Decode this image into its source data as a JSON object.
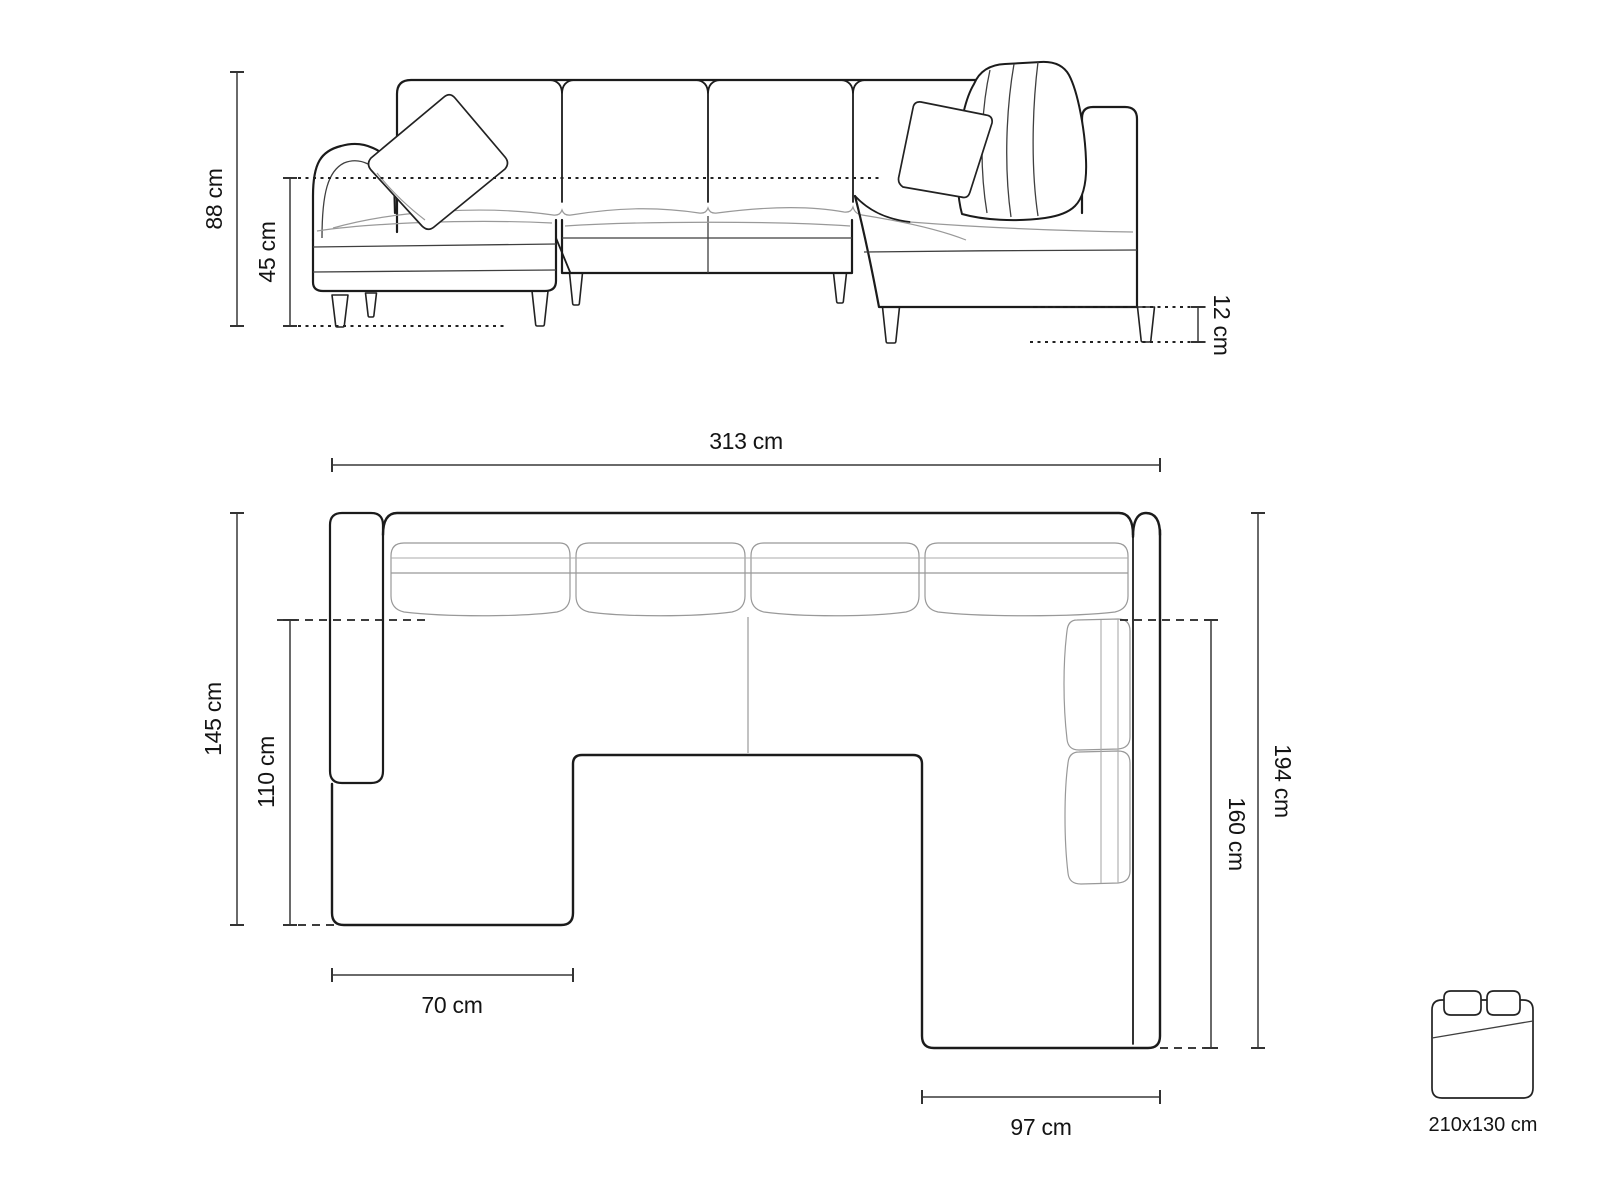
{
  "diagram": {
    "type": "sofa-dimension-drawing",
    "background": "#ffffff",
    "colors": {
      "outline": "#1b1b1b",
      "seam": "#999999",
      "dimension_line": "#6a6a6a",
      "label": "#141414"
    }
  },
  "views": {
    "front": {
      "name": "front-elevation",
      "dims": {
        "total_height": "88 cm",
        "seat_height": "45 cm",
        "leg_height": "12 cm"
      }
    },
    "plan": {
      "name": "top-plan",
      "dims": {
        "total_width": "313 cm",
        "left_depth": "145 cm",
        "left_inner_depth": "110 cm",
        "chaise_width": "70 cm",
        "right_width": "97 cm",
        "right_inner_depth": "160 cm",
        "right_depth": "194 cm"
      }
    }
  },
  "sleeping_area": {
    "icon": "bed-icon",
    "label": "210x130 cm"
  }
}
